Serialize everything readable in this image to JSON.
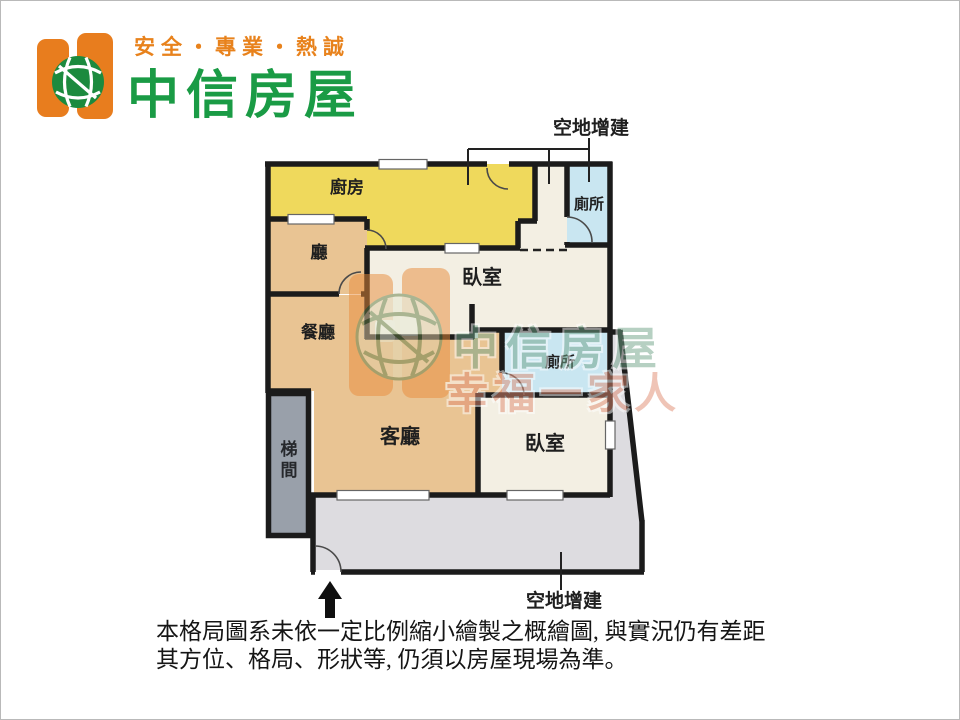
{
  "header": {
    "slogan": "安全・專業・熱誠",
    "brand": "中信房屋",
    "slogan_color": "#e8821c",
    "brand_color": "#1a9b45",
    "logo_orange": "#e87d1e",
    "logo_green": "#1c8a3e"
  },
  "floorplan": {
    "rooms": {
      "kitchen": "廚房",
      "hall": "廳",
      "dining": "餐廳",
      "living": "客廳",
      "bedroom_top": "臥室",
      "bedroom_bottom": "臥室",
      "toilet_top": "廁所",
      "toilet_mid": "廁所",
      "stairwell": "梯間",
      "addition_top": "空地增建",
      "addition_bottom": "空地增建"
    },
    "colors": {
      "kitchen": "#efd95c",
      "living": "#e9c493",
      "bedroom": "#f3efe3",
      "toilet": "#c9e6f1",
      "stairwell": "#99a0aa",
      "addition": "#dddce0",
      "wall": "#1b1b1b",
      "window_fill": "#ffffff",
      "door_stroke": "#4a4a4a"
    }
  },
  "watermark": {
    "brand": "中信房屋",
    "tagline": "幸福一家人"
  },
  "disclaimer": {
    "line1": "本格局圖系未依一定比例縮小繪製之概繪圖, 與實況仍有差距",
    "line2": "其方位、格局、形狀等, 仍須以房屋現場為準。"
  }
}
